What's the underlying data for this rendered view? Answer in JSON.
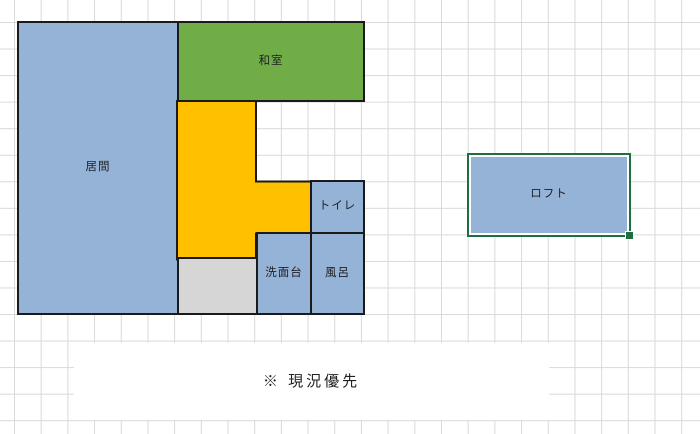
{
  "app": {
    "kind": "spreadsheet-floorplan",
    "grid_visible": true
  },
  "rooms": {
    "living": {
      "label": "居間",
      "color": "#95B3D7"
    },
    "washitsu": {
      "label": "和室",
      "color": "#70AD47"
    },
    "hallway": {
      "label": "",
      "color": "#FFC000"
    },
    "toilet": {
      "label": "トイレ",
      "color": "#95B3D7"
    },
    "washbasin": {
      "label": "洗面台",
      "color": "#95B3D7"
    },
    "bath": {
      "label": "風呂",
      "color": "#95B3D7"
    },
    "utility": {
      "label": "",
      "color": "#D6D6D6"
    },
    "loft": {
      "label": "ロフト",
      "color": "#95B3D7",
      "selected": true,
      "selection_color": "#1E6E41"
    }
  },
  "note": {
    "text": "※ 現況優先"
  },
  "colors": {
    "background": "#FFFFFF",
    "grid_line": "#D9D9D9",
    "shape_outline": "#1A1A1A",
    "text": "#1F1F24",
    "selection_green": "#1E6E41"
  }
}
